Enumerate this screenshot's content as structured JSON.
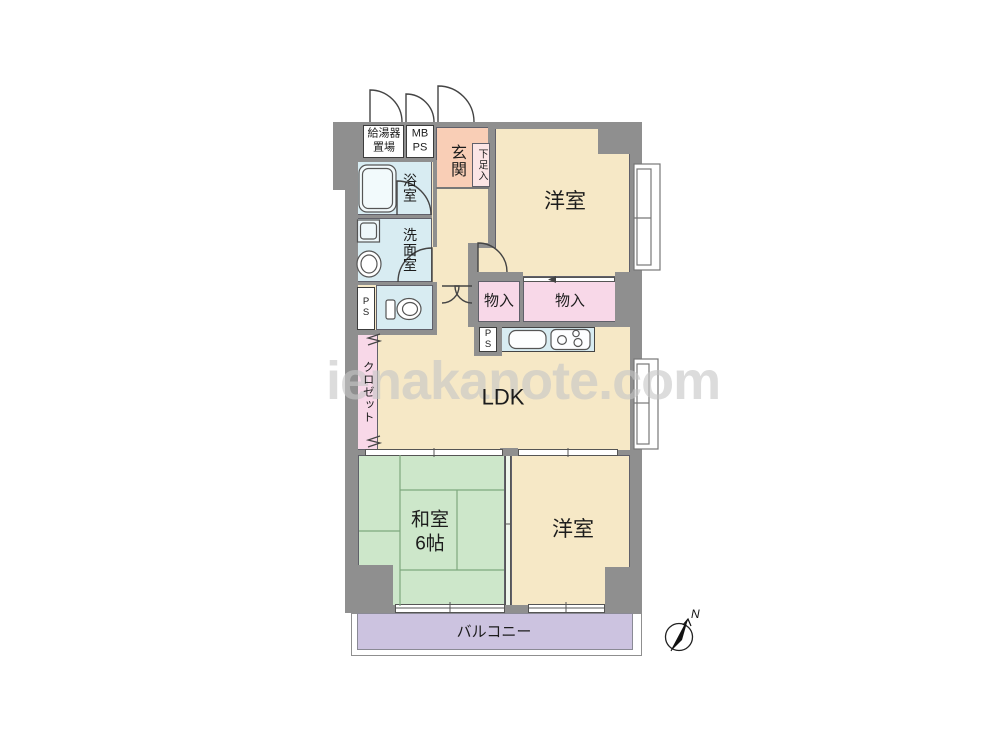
{
  "watermark": {
    "text": "ienakanote.com"
  },
  "compass": {
    "north_label": "N"
  },
  "labels": {
    "water_heater": "給湯器\n置場",
    "meter_pipe_space": "MB\nPS",
    "entrance": "玄関",
    "shoe_box": "下足入",
    "western_room_top": "洋室",
    "bathroom": "浴室",
    "washroom": "洗面室",
    "toilet_pipe_space": "P\nS",
    "storage_left": "物入",
    "storage_right": "物入",
    "kitchen_pipe_space": "P\nS",
    "closet": "クロゼット",
    "living": "LDK",
    "japanese_room": "和室\n6帖",
    "western_room_bottom": "洋室",
    "balcony": "バルコニー"
  },
  "colors": {
    "wall": "#8f8f8f",
    "floor_beige": "#f6e8c6",
    "entrance_salmon": "#f9ceb6",
    "wet_area_blue": "#d8ecf2",
    "storage_pink": "#f8d8e8",
    "shoe_box_pink": "#fbe5e5",
    "tatami_green": "#cde7ca",
    "balcony_purple": "#ccc3e0",
    "watermark_gray": "#c7c7c7"
  }
}
